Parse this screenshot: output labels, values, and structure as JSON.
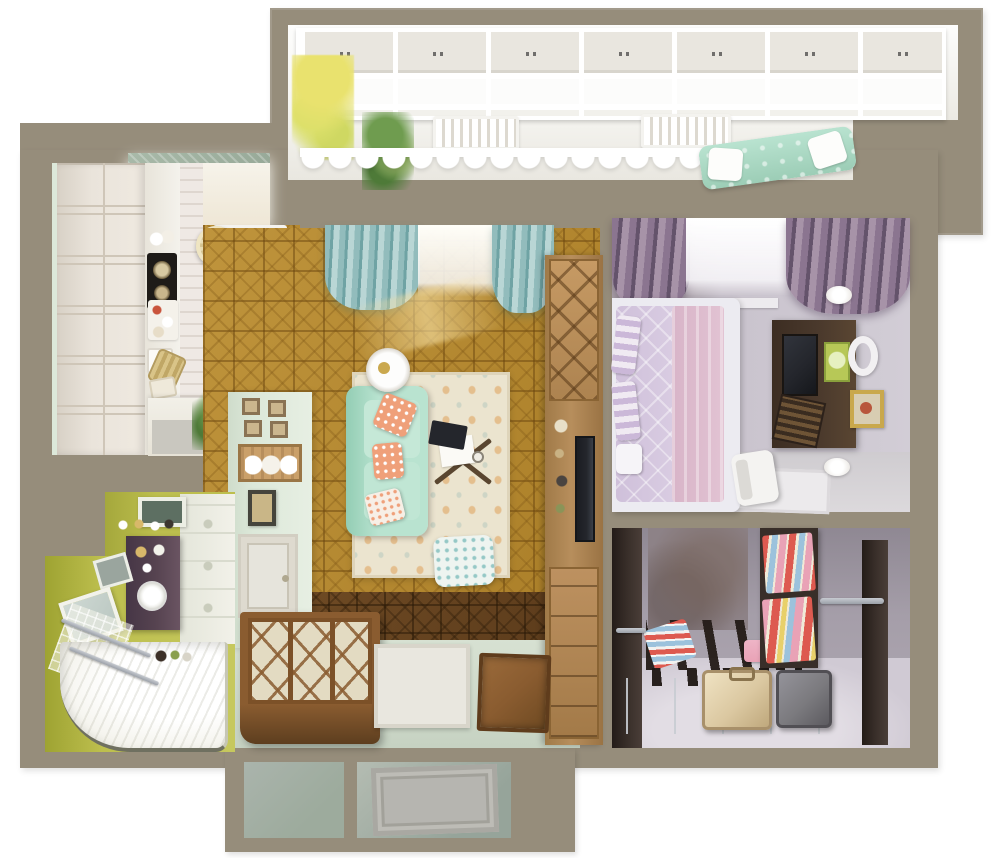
{
  "scene": {
    "type": "3d-floor-plan-top-view",
    "description": "Photorealistic top-down 3D render of a one-bedroom apartment floor plan with glazed balcony, open kitchen-living room, bedroom, walk-in dressing room, bathroom, hallway and entry vestibule",
    "canvas": {
      "width": 1000,
      "height": 858
    }
  },
  "colors": {
    "white": "#ffffff",
    "wall": "#968d7b",
    "balcony-floor": "#f6f5f1",
    "window-frame": "#ffffff",
    "window-blind": "#e9e6df",
    "parquet-gold": "#bf943c",
    "parquet-brown": "#6e4a24",
    "rug-base": "#ebe4cf",
    "sofa-mint": "#b9e3d0",
    "sofa-mint-deep": "#93cdb4",
    "pillow-coral": "#efa07a",
    "curtain-teal": "#92bcbc",
    "curtain-teal-deep": "#6fa3a4",
    "sun-glow": "#f3dc9e",
    "cabinet-white": "#eae4db",
    "cabinet-line": "#cfc6b8",
    "counter-white": "#f4f2ec",
    "cooktop-black": "#1e1b18",
    "table-blush": "#e9cfc4",
    "stool-cream": "#e8dcb4",
    "ceiling-panel": "#a9baa9",
    "mint-wall": "#dce8d9",
    "frame-sepia": "#8a7354",
    "wood-light": "#b78e5c",
    "wood-mid": "#8a5c30",
    "wood-dark": "#5d3e1f",
    "bedroom-wall": "#c9c3cd",
    "bedroom-concrete": "#aaa1a8",
    "curtain-purple": "#8b7590",
    "curtain-purple-deep": "#64536b",
    "bed-lilac": "#d9cce2",
    "bed-pink": "#e2c3d3",
    "bed-white": "#ecebf1",
    "unit-espresso": "#4a392c",
    "screen-dark": "#24262c",
    "art-green": "#b7c857",
    "frame-gold": "#c9a84c",
    "closet-wall": "#a59ea9",
    "closet-concrete": "#8d8287",
    "closet-dark": "#382e29",
    "closet-floor": "#d0cad4",
    "chrome": "#c7cbd1",
    "clothes-red": "#dd5a50",
    "clothes-pink": "#e9a2b6",
    "clothes-blue": "#9cc2dc",
    "clothes-cream": "#f0ead8",
    "suitcase-beige": "#dbc8a1",
    "suitcase-grey": "#7b7a7e",
    "bath-wall": "#bdbf4e",
    "bath-wall-deep": "#a5a83c",
    "bath-white": "#f2f1e9",
    "vanity-plum": "#564350",
    "mirror-glass": "#b9c6c0",
    "hall-floor": "#d7e1d2",
    "door-white": "#e9e7df",
    "door-glass": "#8a5e2e",
    "mat-brown": "#8a5c30",
    "vestibule-a": "#9dab9d",
    "vestibule-b": "#aab4ac",
    "plant-green": "#6f9c4f",
    "plant-deep": "#4e7a38",
    "flower-yellow": "#e9e26e"
  },
  "rooms": {
    "balcony": {
      "name": "Balcony",
      "items": [
        "window-row-with-roller-blinds",
        "yellow-flowers",
        "hanging-plant",
        "radiator",
        "radiator",
        "scalloped-valance",
        "mint-tufted-bench"
      ]
    },
    "kitchen": {
      "name": "Kitchen",
      "items": [
        "ceiling-light-panel",
        "cabinet-run",
        "countertop",
        "cooktop",
        "round-dining-table",
        "tufted-stool",
        "tufted-stool",
        "radiator",
        "half-wall",
        "potted-plant"
      ]
    },
    "living_room": {
      "name": "Living room",
      "items": [
        "teal-curtains",
        "sheer-curtain",
        "gold-parquet",
        "area-rug",
        "mint-sofa",
        "coral-pillows",
        "tray-side-table",
        "cross-leg-coffee-table",
        "laptop",
        "pouf",
        "media-wall-unit",
        "tv",
        "display-partition",
        "plate-rack",
        "picture-frames",
        "storage-chest-bench"
      ]
    },
    "bedroom": {
      "name": "Bedroom",
      "items": [
        "purple-curtains",
        "sheer-curtain",
        "double-bed",
        "lilac-duvet",
        "striped-pillows",
        "wall-tv-cabinet",
        "tv-screen",
        "slatted-box",
        "green-artwork",
        "round-mirror",
        "gold-picture-frame",
        "wall-sconce",
        "wall-sconce",
        "white-chair",
        "floor-mat"
      ]
    },
    "dressing_room": {
      "name": "Dressing room",
      "items": [
        "clothes-shelving",
        "folded-clothes",
        "hanging-rod",
        "hanging-rod",
        "rack-dividers",
        "suitcase-beige",
        "suitcase-grey"
      ]
    },
    "bathroom": {
      "name": "Bathroom",
      "items": [
        "chartreuse-walls",
        "wall-cabinets",
        "artwork",
        "vanity",
        "round-sink",
        "mirror",
        "towel-rail",
        "towel-rail",
        "shower-tray",
        "toiletries"
      ]
    },
    "hallway": {
      "name": "Hallway",
      "items": [
        "glazed-entry-door",
        "doormat",
        "storage-chest-bench",
        "chest-of-drawers"
      ]
    },
    "vestibule": {
      "name": "Vestibule",
      "items": [
        "entry-cell",
        "entry-cell-with-door-leaf"
      ]
    }
  }
}
